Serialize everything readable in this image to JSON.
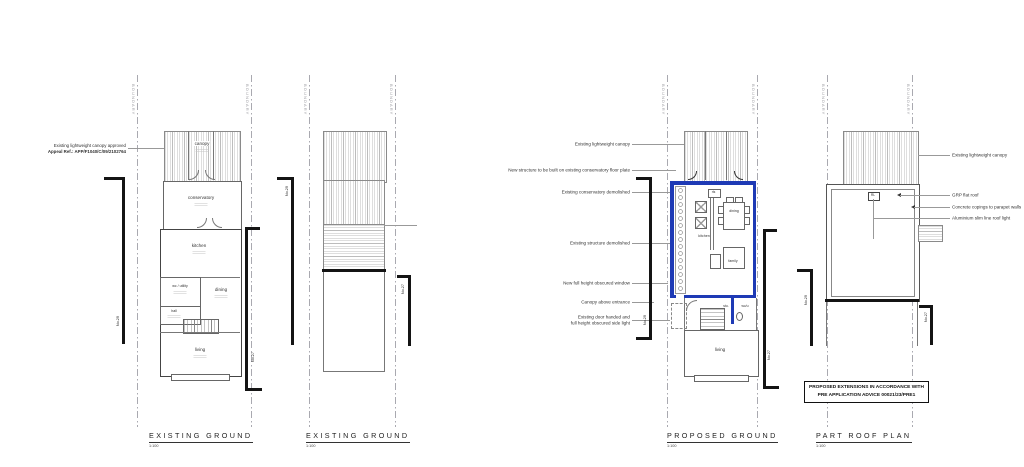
{
  "colors": {
    "accent_blue": "#1e3ab5"
  },
  "boundary_label": "BOUNDARY",
  "plan1": {
    "title": "EXISTING GROUND",
    "scale": "1:100",
    "annotation": {
      "line1": "Existing lightweight canopy approved",
      "line2": "Appeal Ref.: APP/F1040/C/09/2102764"
    },
    "rooms": {
      "canopy": "canopy",
      "conservatory": "conservatory",
      "kitchen": "kitchen",
      "wc": "wc / utility",
      "dining": "dining",
      "hall": "hall",
      "living": "living"
    },
    "neighbors": {
      "left": "No.29",
      "right": "No.27"
    }
  },
  "plan2": {
    "title": "EXISTING GROUND",
    "scale": "1:100",
    "neighbors": {
      "left": "No.29",
      "right": "No.27"
    }
  },
  "plan3": {
    "title": "PROPOSED GROUND",
    "scale": "1:100",
    "rooms": {
      "kitchen": "kitchen",
      "dining": "dining",
      "family": "family",
      "study": "stu.",
      "wc": "wc/u",
      "living": "living",
      "rooflight": "rls"
    },
    "ann": {
      "a1": "Existing lightweight canopy",
      "a2": "New structure to be built on existing conservatory floor plate",
      "a3": "Existing conservatory demolished",
      "a4": "Existing structure demolished",
      "a5": "New full height obscured window",
      "a6": "Canopy above entrance",
      "a7a": "Existing door handed and",
      "a7b": "full height obscured side light"
    },
    "neighbors": {
      "left": "No.29",
      "right": "No.27"
    }
  },
  "plan4": {
    "title": "PART ROOF PLAN",
    "scale": "1:100",
    "rooflight": "RL",
    "ann": {
      "a1": "Existing lightweight canopy",
      "a2": "GRP flat roof",
      "a3": "Concrete copings to parapet walls",
      "a4": "Aluminium slim line roof light"
    },
    "neighbors": {
      "left": "No.29",
      "right": "No.27"
    }
  },
  "note_box": {
    "line1": "PROPOSED EXTENSIONS IN ACCORDANCE WITH",
    "line2": "PRE APPLICATION ADVICE 00021/23/PRE1"
  }
}
